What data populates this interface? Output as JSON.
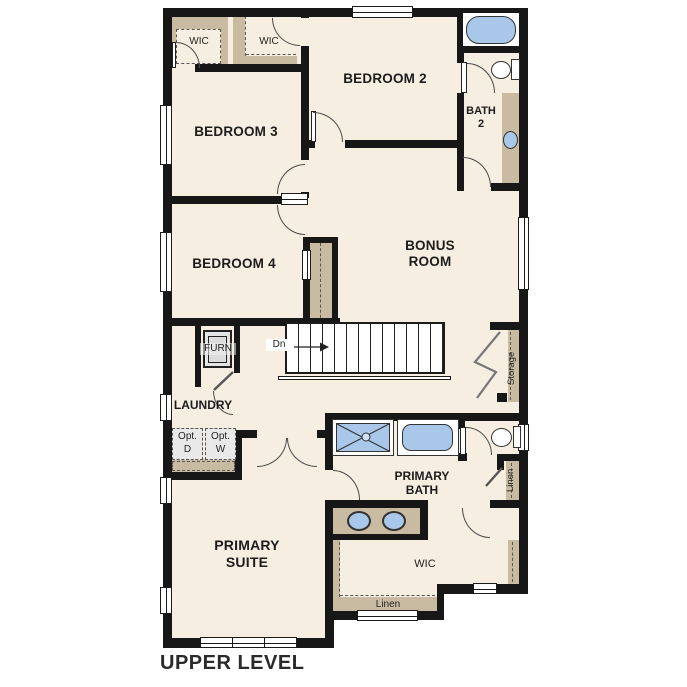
{
  "plan": {
    "title": "UPPER LEVEL",
    "level": "Upper Level Floor Plan"
  },
  "rooms": {
    "bedroom2": "BEDROOM 2",
    "bedroom3": "BEDROOM 3",
    "bedroom4": "BEDROOM 4",
    "bonus_line1": "BONUS",
    "bonus_line2": "ROOM",
    "bath2_line1": "BATH",
    "bath2_line2": "2",
    "primary_bath_line1": "PRIMARY",
    "primary_bath_line2": "BATH",
    "primary_suite_line1": "PRIMARY",
    "primary_suite_line2": "SUITE",
    "laundry": "LAUNDRY",
    "furn": "FURN",
    "wic_bed3": "WIC",
    "wic_bed2": "WIC",
    "wic_primary": "WIC",
    "storage": "Storage",
    "linen_closet": "Linen",
    "linen_shelf": "Linen",
    "opt_d_line1": "Opt.",
    "opt_d_line2": "D",
    "opt_w_line1": "Opt.",
    "opt_w_line2": "W",
    "stairs_down": "Dn"
  },
  "colors": {
    "floor": "#f6eee1",
    "wall": "#171717",
    "casework_tan": "#c9bba1",
    "fixture_blue": "#a9c7e8",
    "appliance_gray": "#e9e9e9"
  }
}
